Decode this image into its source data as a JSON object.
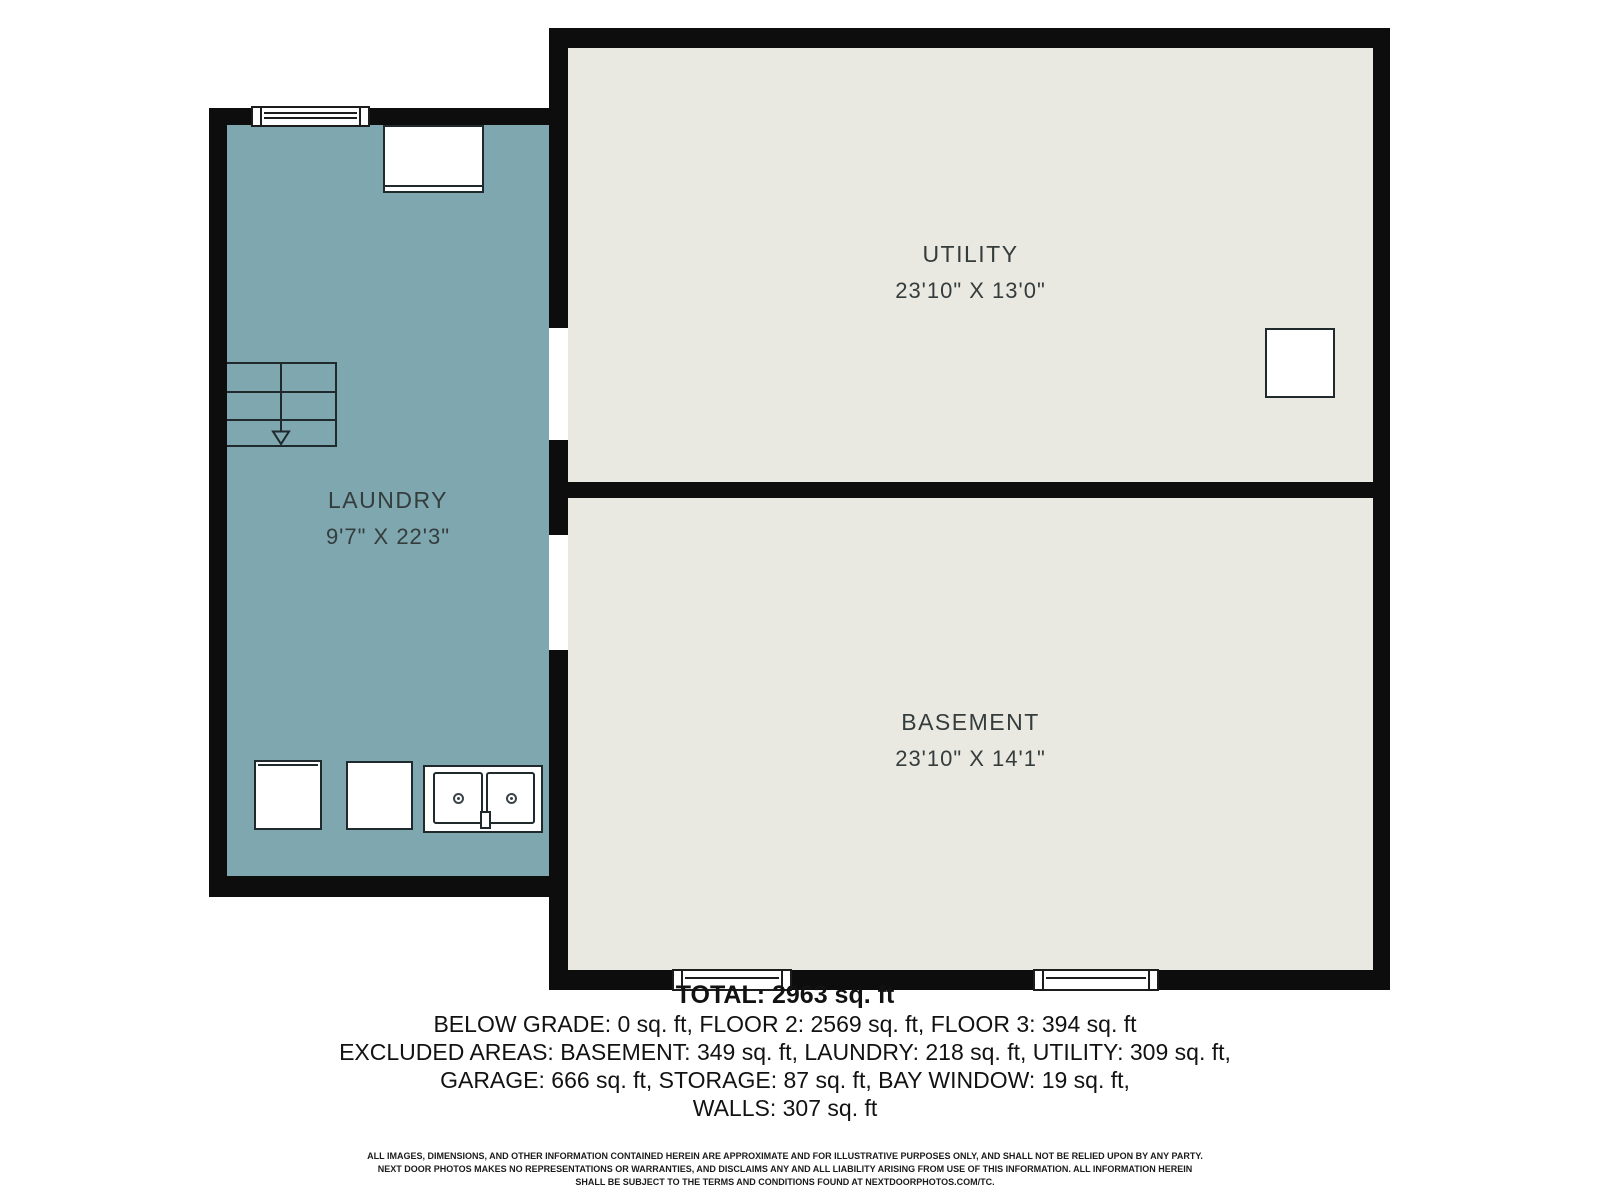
{
  "floorplan": {
    "rooms": {
      "laundry": {
        "name": "LAUNDRY",
        "dims": "9'7\" X 22'3\""
      },
      "utility": {
        "name": "UTILITY",
        "dims": "23'10\" X 13'0\""
      },
      "basement": {
        "name": "BASEMENT",
        "dims": "23'10\" X 14'1\""
      }
    }
  },
  "summary": {
    "total": "TOTAL: 2963 sq. ft",
    "line1": "BELOW GRADE: 0 sq. ft, FLOOR 2: 2569 sq. ft, FLOOR 3: 394 sq. ft",
    "line2": "EXCLUDED AREAS: BASEMENT: 349 sq. ft, LAUNDRY: 218 sq. ft, UTILITY: 309 sq. ft,",
    "line3": "GARAGE: 666 sq. ft, STORAGE: 87 sq. ft, BAY WINDOW: 19 sq. ft,",
    "line4": "WALLS: 307 sq. ft"
  },
  "disclaimer": {
    "line1": "ALL IMAGES, DIMENSIONS, AND OTHER INFORMATION CONTAINED HEREIN ARE APPROXIMATE AND FOR ILLUSTRATIVE PURPOSES ONLY, AND SHALL NOT BE RELIED UPON BY ANY PARTY.",
    "line2": "NEXT DOOR PHOTOS MAKES NO REPRESENTATIONS OR WARRANTIES, AND DISCLAIMS ANY AND ALL LIABILITY ARISING FROM USE OF THIS INFORMATION. ALL INFORMATION HEREIN",
    "line3": "SHALL BE SUBJECT TO THE TERMS AND CONDITIONS FOUND AT NEXTDOORPHOTOS.COM/TC."
  },
  "colors": {
    "wall": "#0d0d0d",
    "laundry-fill": "#7ea7b0",
    "room-fill": "#e9e9e1",
    "fixture-stroke": "#20292c",
    "label-text": "#353c3c",
    "summary-text": "#121212"
  }
}
